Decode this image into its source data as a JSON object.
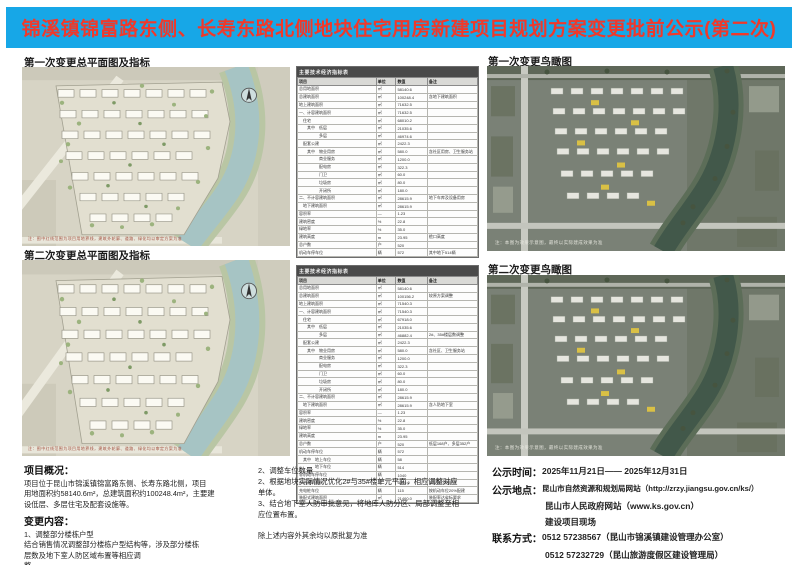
{
  "title": "锦溪镇锦富路东侧、长寿东路北侧地块住宅用房新建项目规划方案变更批前公示(第二次)",
  "colors": {
    "banner_blue": "#17a7e7",
    "banner_red": "#f0392b"
  },
  "sections": {
    "plan1_label": "第一次变更总平面图及指标",
    "plan2_label": "第二次变更总平面图及指标",
    "aerial1_label": "第一次变更鸟瞰图",
    "aerial2_label": "第二次变更鸟瞰图"
  },
  "plan_caption": "注：图中红线范围为项目用地界线，建筑外轮廓、道路、绿化均以审定方案为准",
  "aerial_caption": "注：本图为效果示意图，最终以实际建成效果为准",
  "table1": {
    "title": "主要技术经济指标表",
    "headers": [
      "项目",
      "单位",
      "数值",
      "备注"
    ],
    "rows": [
      [
        "总用地面积",
        "㎡",
        "58140.6",
        ""
      ],
      [
        "总建筑面积",
        "㎡",
        "100248.4",
        "含地下建筑面积"
      ],
      [
        "地上建筑面积",
        "㎡",
        "71632.5",
        ""
      ],
      [
        "一、计容建筑面积",
        "㎡",
        "71632.5",
        ""
      ],
      [
        "　住宅",
        "㎡",
        "68010.2",
        ""
      ],
      [
        "　　其中　低层",
        "㎡",
        "21035.6",
        ""
      ],
      [
        "　　　　　多层",
        "㎡",
        "46974.6",
        ""
      ],
      [
        "　配套公建",
        "㎡",
        "2422.3",
        ""
      ],
      [
        "　　其中　物业用房",
        "㎡",
        "580.0",
        "含社区用房、卫生服务站"
      ],
      [
        "　　　　　商业服务",
        "㎡",
        "1200.0",
        ""
      ],
      [
        "　　　　　配电房",
        "㎡",
        "322.3",
        ""
      ],
      [
        "　　　　　门卫",
        "㎡",
        "60.0",
        ""
      ],
      [
        "　　　　　垃圾房",
        "㎡",
        "80.0",
        ""
      ],
      [
        "　　　　　开闭所",
        "㎡",
        "180.0",
        ""
      ],
      [
        "二、不计容建筑面积",
        "㎡",
        "28615.9",
        "地下车库及设备用房"
      ],
      [
        "　地下建筑面积",
        "㎡",
        "28615.9",
        ""
      ],
      [
        "容积率",
        "—",
        "1.23",
        ""
      ],
      [
        "建筑密度",
        "%",
        "22.8",
        ""
      ],
      [
        "绿地率",
        "%",
        "35.0",
        ""
      ],
      [
        "建筑高度",
        "m",
        "23.95",
        "檐口高度"
      ],
      [
        "总户数",
        "户",
        "520",
        ""
      ],
      [
        "机动车停车位",
        "辆",
        "572",
        "其中地下514辆"
      ]
    ]
  },
  "table2": {
    "title": "主要技术经济指标表",
    "headers": [
      "项目",
      "单位",
      "数值",
      "备注"
    ],
    "rows": [
      [
        "总用地面积",
        "㎡",
        "58140.6",
        ""
      ],
      [
        "总建筑面积",
        "㎡",
        "100156.2",
        "较原方案调整"
      ],
      [
        "地上建筑面积",
        "㎡",
        "71540.3",
        ""
      ],
      [
        "一、计容建筑面积",
        "㎡",
        "71540.3",
        ""
      ],
      [
        "　住宅",
        "㎡",
        "67918.0",
        ""
      ],
      [
        "　　其中　低层",
        "㎡",
        "21035.6",
        ""
      ],
      [
        "　　　　　多层",
        "㎡",
        "46882.4",
        "2#、35#楼层数调整"
      ],
      [
        "　配套公建",
        "㎡",
        "2422.3",
        ""
      ],
      [
        "　　其中　物业用房",
        "㎡",
        "580.0",
        "含社区、卫生服务站"
      ],
      [
        "　　　　　商业服务",
        "㎡",
        "1200.0",
        ""
      ],
      [
        "　　　　　配电房",
        "㎡",
        "322.3",
        ""
      ],
      [
        "　　　　　门卫",
        "㎡",
        "60.0",
        ""
      ],
      [
        "　　　　　垃圾房",
        "㎡",
        "80.0",
        ""
      ],
      [
        "　　　　　开闭所",
        "㎡",
        "180.0",
        ""
      ],
      [
        "二、不计容建筑面积",
        "㎡",
        "28615.9",
        ""
      ],
      [
        "　地下建筑面积",
        "㎡",
        "28615.9",
        "含人防地下室"
      ],
      [
        "容积率",
        "—",
        "1.23",
        ""
      ],
      [
        "建筑密度",
        "%",
        "22.8",
        ""
      ],
      [
        "绿地率",
        "%",
        "35.0",
        ""
      ],
      [
        "建筑高度",
        "m",
        "23.95",
        ""
      ],
      [
        "总户数",
        "户",
        "520",
        "低层168户、多层352户"
      ],
      [
        "机动车停车位",
        "辆",
        "572",
        ""
      ],
      [
        "　其中　地上车位",
        "辆",
        "58",
        ""
      ],
      [
        "　　　　地下车位",
        "辆",
        "514",
        ""
      ],
      [
        "非机动车停车位",
        "辆",
        "1040",
        ""
      ],
      [
        "人防建筑面积",
        "㎡",
        "6200.0",
        "按规定比例配建"
      ],
      [
        "充电桩车位",
        "辆",
        "115",
        "按机动车位20%配建"
      ],
      [
        "装配式建筑面积",
        "㎡",
        "21460.0",
        "装配率达省标要求"
      ]
    ]
  },
  "overview": {
    "heading": "项目概况：",
    "lines": [
      "项目位于昆山市锦溪镇锦富路东侧、长寿东路北侧，项目",
      "用地面积约58140.6m²，总建筑面积约100248.4m²，主要建",
      "设低层、多层住宅及配套设施等。"
    ]
  },
  "changes": {
    "heading": "变更内容：",
    "lines": [
      "1、调整部分楼栋户型",
      "结合销售情况调整部分楼栋户型结构等，涉及部分楼栋",
      "层数及地下室人防区域布置等相应调",
      "整。"
    ]
  },
  "midnotes": {
    "lines": [
      "2、调整车位数量",
      "2、根据地块实际情况优化2#与35#楼单元平面，相应调整对应",
      "单体。",
      "3、结合地下室人防审批意见，将地库人防分区、局部调整至相",
      "应位置布置。"
    ],
    "footer": "除上述内容外其余均以原批复为准"
  },
  "notice": {
    "time_label": "公示时间：",
    "time_value": "2025年11月21日—— 2025年12月31日",
    "place_label": "公示地点：",
    "place_line1": "昆山市自然资源和规划局网站（http://zrzy.jiangsu.gov.cn/ks/）",
    "place_lines": [
      "昆山市人民政府网站（www.ks.gov.cn）",
      "建设项目现场"
    ],
    "contact_label": "联系方式：",
    "contact_line1": "0512 57238567（昆山市锦溪镇建设管理办公室）",
    "contact_lines": [
      "0512 57232729（昆山旅游度假区建设管理局）"
    ],
    "email_label": "邮　　箱：",
    "email_value": "ldqjg@163.com（昆山旅游度假区建设管理局）"
  }
}
